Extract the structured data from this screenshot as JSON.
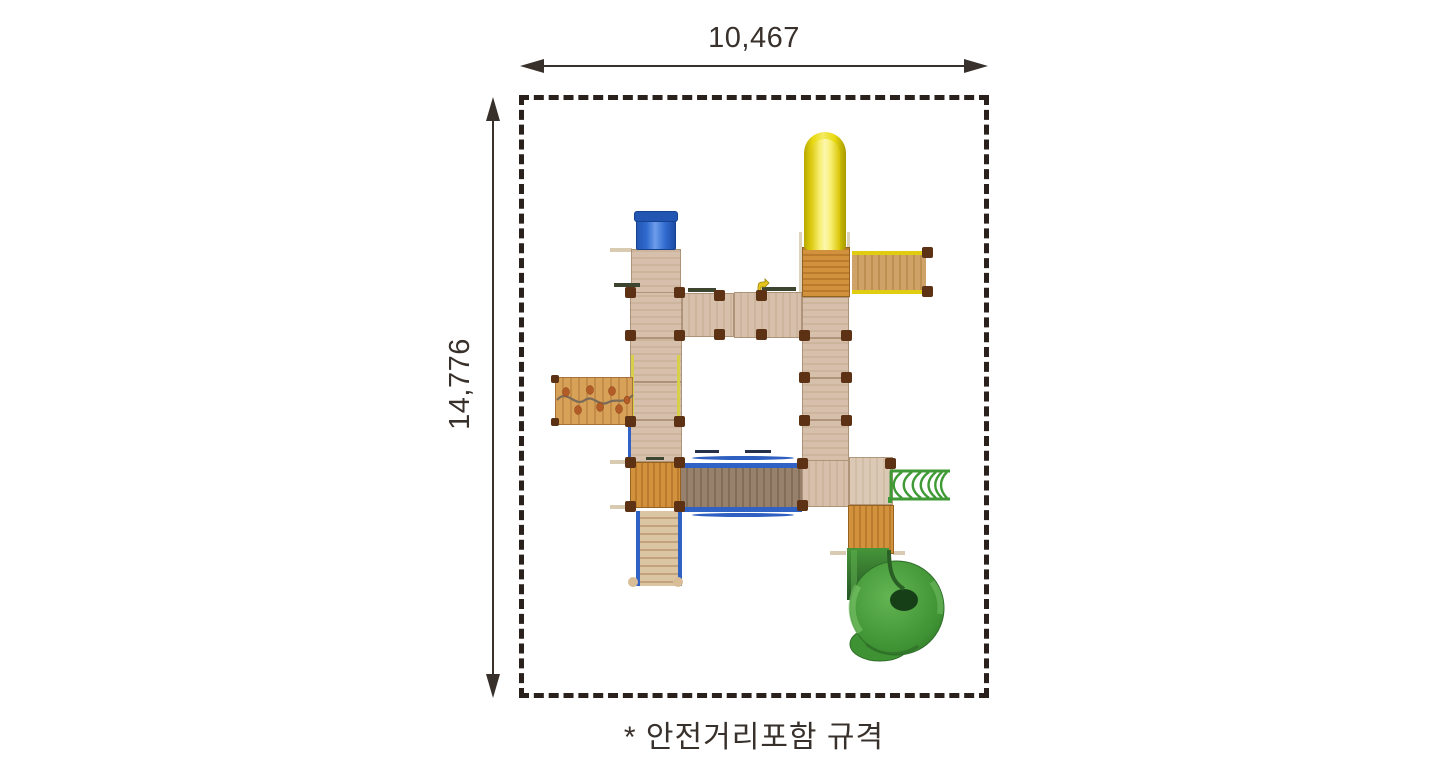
{
  "drawing": {
    "width_dimension": "10,467",
    "height_dimension": "14,776",
    "footnote": "* 안전거리포함 규격"
  },
  "colors": {
    "outline": "#38302B",
    "boundary_dash": "#2A211D",
    "platform_tan": "#D5BFA9",
    "deck_orange": "#D2913C",
    "slide_yellow": "#EFE01B",
    "box_blue": "#3069CC",
    "rail_blue": "#3061C4",
    "rail_yellow": "#E0CD12",
    "bridge_wood": "#97816C",
    "slide_green": "#4AA23C"
  },
  "components": [
    "yellow-tube-slide",
    "blue-box-climber",
    "wood-platform-grid",
    "climbing-wall",
    "rope-suspension-bridge",
    "yellow-rail-bridge",
    "green-arch-ladder",
    "green-spiral-tube-slide",
    "stairway",
    "orange-deck-platforms"
  ]
}
